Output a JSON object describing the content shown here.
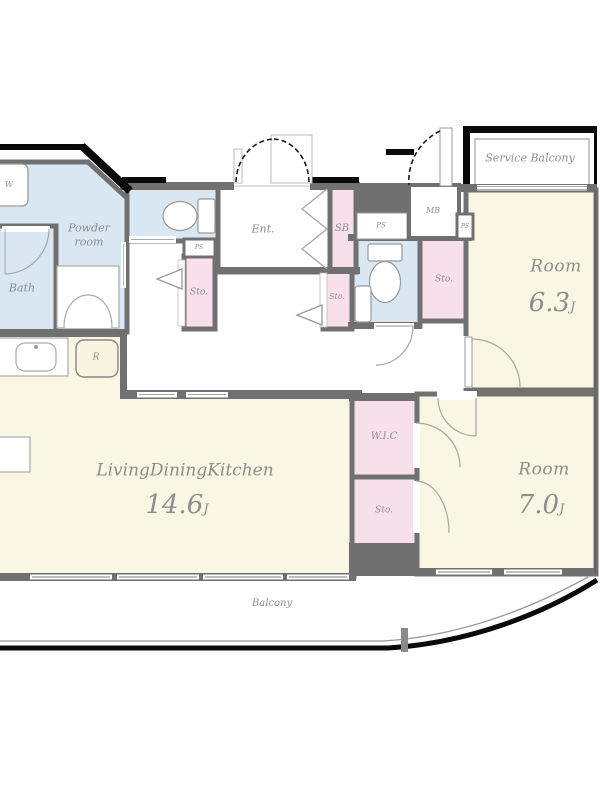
{
  "plan": {
    "type": "apartment-floor-plan",
    "palette": {
      "room_cream": "#faf6e4",
      "wet_area_blue": "#d9e7f2",
      "storage_pink": "#f7e0ea",
      "wall_gray": "#707070",
      "outline_black": "#0a0a0a",
      "label_gray": "#8d8d8d"
    },
    "labels": {
      "ldk_name": "LivingDiningKitchen",
      "ldk_area": "14.6",
      "room1_name": "Room",
      "room1_area": "6.3",
      "room2_name": "Room",
      "room2_area": "7.0",
      "unit": "J",
      "balcony": "Balcony",
      "service_balcony": "Service Balcony",
      "entrance": "Ent.",
      "bath": "Bath",
      "powder_line1": "Powder",
      "powder_line2": "room",
      "wic": "W.I.C",
      "shoe_box": "SB",
      "meter_box": "MB",
      "pipe_space_1": "PS",
      "pipe_space_2": "PS",
      "pipe_space_3": "PS",
      "storage_hall": "Sto.",
      "storage_entry": "Sto.",
      "storage_east": "Sto.",
      "storage_south": "Sto.",
      "washer": "W",
      "refrigerator": "R"
    }
  }
}
